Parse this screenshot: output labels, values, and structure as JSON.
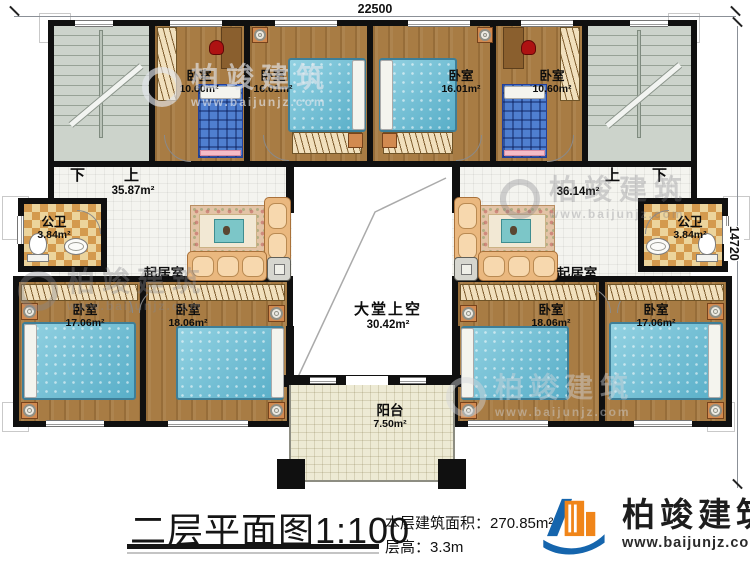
{
  "dimensions": {
    "top": "22500",
    "right": "14720"
  },
  "halls": {
    "left": {
      "down_label": "下",
      "up_label": "上",
      "area": "35.87m²"
    },
    "right": {
      "up_label": "上",
      "down_label": "下",
      "area": "36.14m²"
    }
  },
  "rooms": {
    "bedroom_top_left_small": {
      "name": "卧室",
      "area": "10.60m²"
    },
    "bedroom_top_left_large": {
      "name": "卧室",
      "area": "16.01m²"
    },
    "bedroom_top_right_large": {
      "name": "卧室",
      "area": "16.01m²"
    },
    "bedroom_top_right_small": {
      "name": "卧室",
      "area": "10.60m²"
    },
    "bath_left": {
      "name": "公卫",
      "area": "3.84m²"
    },
    "bath_right": {
      "name": "公卫",
      "area": "3.84m²"
    },
    "living_left": {
      "name": "起居室"
    },
    "living_right": {
      "name": "起居室"
    },
    "hall_void": {
      "name": "大堂上空",
      "area": "30.42m²"
    },
    "balcony": {
      "name": "阳台",
      "area": "7.50m²"
    },
    "bedroom_bottom_left_outer": {
      "name": "卧室",
      "area": "17.06m²"
    },
    "bedroom_bottom_left_inner": {
      "name": "卧室",
      "area": "18.06m²"
    },
    "bedroom_bottom_right_inner": {
      "name": "卧室",
      "area": "18.06m²"
    },
    "bedroom_bottom_right_outer": {
      "name": "卧室",
      "area": "17.06m²"
    }
  },
  "title_block": {
    "plan_title": "二层平面图",
    "plan_scale": "1:100",
    "floor_area_label": "本层建筑面积：",
    "floor_area_value": "270.85m²",
    "floor_height_label": "层高：",
    "floor_height_value": "3.3m"
  },
  "brand": {
    "name": "柏竣建筑",
    "website": "www.baijunjz.com"
  },
  "watermark": {
    "name": "柏竣建筑",
    "website": "www.baijunjz.com"
  },
  "colors": {
    "wall": "#101010",
    "wood_floor": "#a87c44",
    "stair_floor": "#ccd3cb",
    "bath_tile": "#d49a4e",
    "balcony_tile": "#edead4",
    "bed_teal": "#6fc0d6",
    "brand_blue": "#1565ad",
    "brand_orange": "#f08519"
  }
}
